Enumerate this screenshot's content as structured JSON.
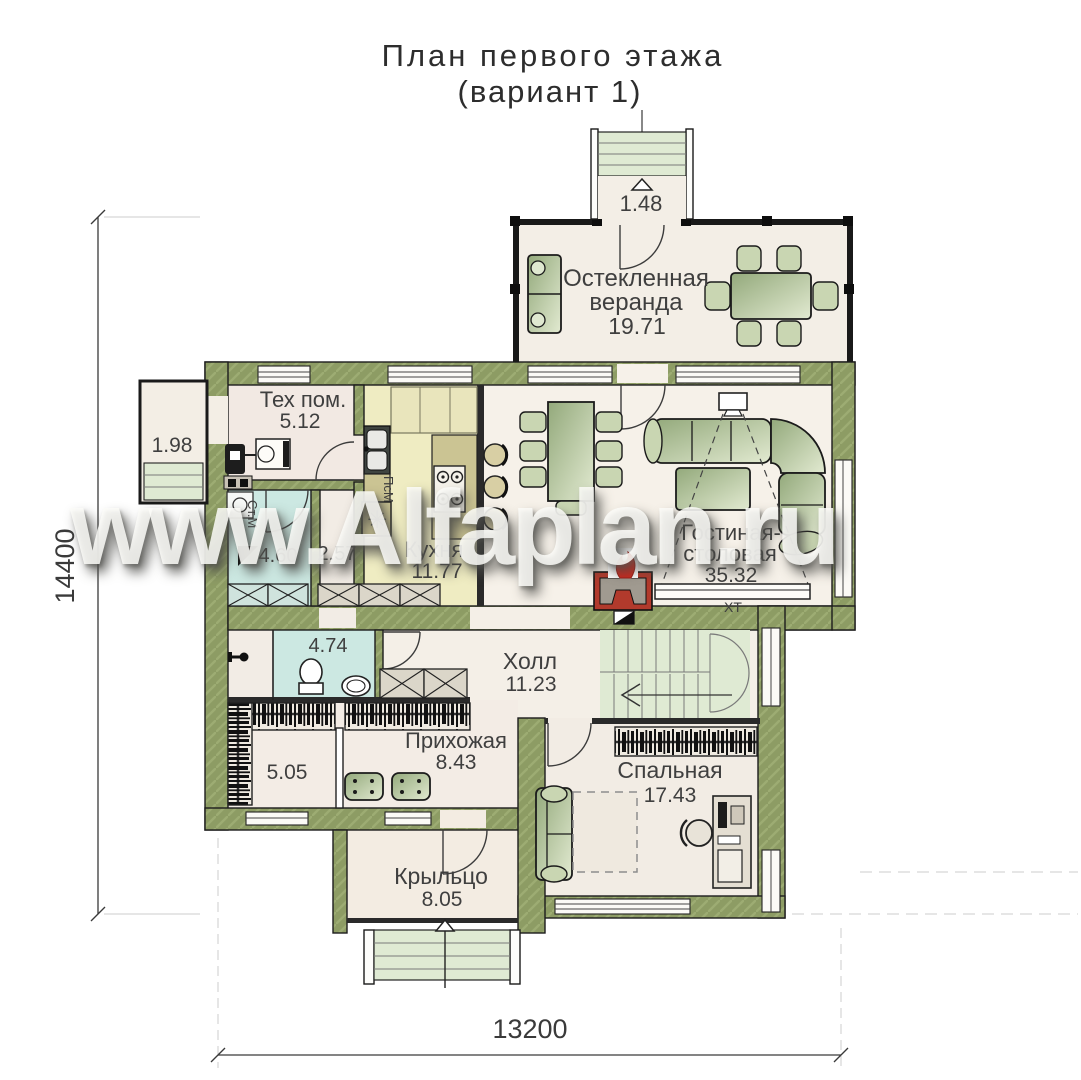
{
  "title": {
    "line1": "План первого этажа",
    "line2": "(вариант 1)"
  },
  "watermark": "www.Alfaplan.ru",
  "dimensions": {
    "height": "14400",
    "width": "13200"
  },
  "rooms": {
    "top_steps": {
      "area": "1.48"
    },
    "veranda": {
      "name1": "Остекленная",
      "name2": "веранда",
      "area": "19.71"
    },
    "side_porch": {
      "area": "1.98"
    },
    "tech": {
      "name": "Тех пом.",
      "area": "5.12"
    },
    "kitchen": {
      "name": "Кухня",
      "area": "11.77"
    },
    "living": {
      "name1": "Гостиная-",
      "name2": "столовая",
      "area": "35.32"
    },
    "shower": {
      "area": "4.60"
    },
    "lobby": {
      "area": "2.57"
    },
    "wc": {
      "area": "4.74"
    },
    "hall": {
      "name": "Холл",
      "area": "11.23"
    },
    "closet": {
      "area": "5.05"
    },
    "entry": {
      "name": "Прихожая",
      "area": "8.43"
    },
    "bedroom": {
      "name": "Спальная",
      "area": "17.43"
    },
    "porch": {
      "name": "Крыльцо",
      "area": "8.05"
    }
  },
  "appliances": {
    "washer": "Ст.М",
    "dishwasher": "ПсМ",
    "kitchen_unit_symbol": "✳",
    "tv_console": "ХТ"
  },
  "colors": {
    "wall": "#8d9c64",
    "floor": "#f4efe7",
    "kitchen_floor": "#efecc2",
    "wet_floor": "#cce8e2",
    "stairs": "#dfead3",
    "furniture": "#a9bb90",
    "fireplace": "#b23a2c"
  }
}
